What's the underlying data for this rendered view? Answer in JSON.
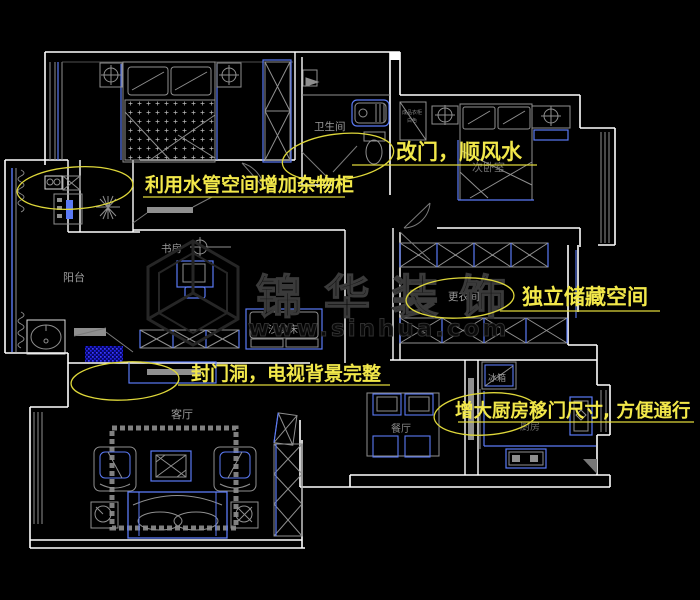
{
  "palette": {
    "background": "#000000",
    "wall": "#ffffff",
    "cad_blue": "#5b7af5",
    "fixture_gray": "#8f8f8f",
    "annotation_yellow": "#f2e84a",
    "highlight_blue": "#2a2af0",
    "label_gray": "#9b9b9b",
    "watermark_gray": "#343434"
  },
  "rooms": {
    "balcony": "阳台",
    "study": "书房",
    "bathroom": "卫生间",
    "second_bedroom": "次卧室",
    "dressing_room": "更衣间",
    "living_room": "客厅",
    "dining_room": "餐厅",
    "kitchen": "厨房"
  },
  "furniture": {
    "sofa_bed": "沙发床",
    "fridge": "冰箱",
    "wardrobe_note_line1": "成品衣柜",
    "wardrobe_note_line2": "白色"
  },
  "annotations": [
    {
      "text": "利用水管空间增加杂物柜"
    },
    {
      "text": "改门，顺风水"
    },
    {
      "text": "独立储藏空间"
    },
    {
      "text": "封门洞，电视背景完整"
    },
    {
      "text": "增大厨房移门尺寸, 方便通行"
    }
  ],
  "watermark": {
    "brand": "锦华装饰",
    "url": "www.sinhua.com"
  }
}
